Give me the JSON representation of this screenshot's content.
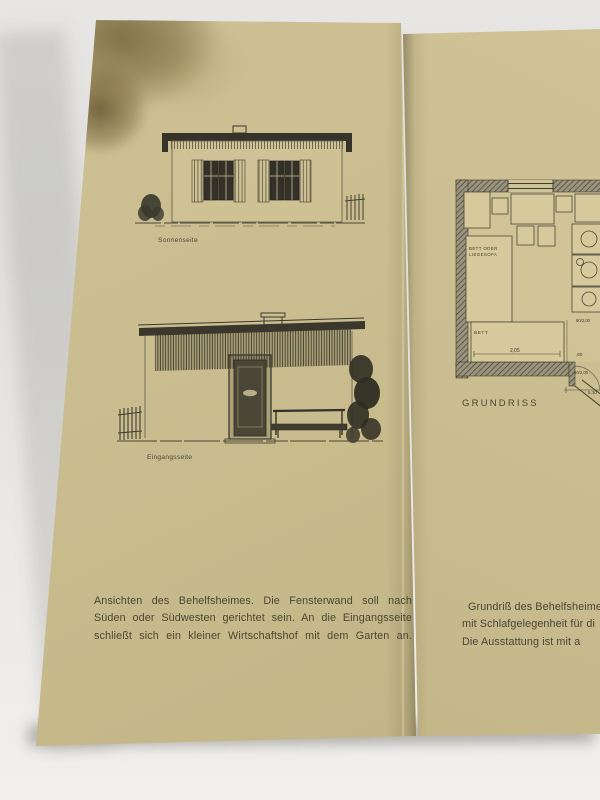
{
  "photo": {
    "background_color": "#e7e6e4",
    "paper_color": "#c9bd8f",
    "ink_color": "#3c392b",
    "stain_color": "#6e5f3c"
  },
  "left_page": {
    "drawing_top": {
      "label": "Sonnenseite"
    },
    "drawing_bottom": {
      "label": "Eingangsseite"
    },
    "caption": {
      "line1": "Ansichten des Behelfsheimes. Die Fensterwand soll nach",
      "line2": "Süden oder Südwesten gerichtet sein. An die Eingangsseite",
      "line3": "schließt sich ein kleiner Wirtschaftshof mit dem Garten an."
    }
  },
  "right_page": {
    "floor_plan": {
      "label": "GRUNDRISS",
      "furniture": {
        "bed_sofa_line1": "BETT ODER",
        "bed_sofa_line2": "LIEGESOFA",
        "bed": "BETT"
      },
      "dimensions": {
        "bed_width": "2,05",
        "opening_right": ",90",
        "door_upper": "80/2,00",
        "door_lower": "90/2,00",
        "overall": "5,10"
      }
    },
    "caption": {
      "line1": "Grundriß des Behelfsheime",
      "line2": "mit Schlafgelegenheit für di",
      "line3": "Die Ausstattung ist mit a"
    }
  }
}
